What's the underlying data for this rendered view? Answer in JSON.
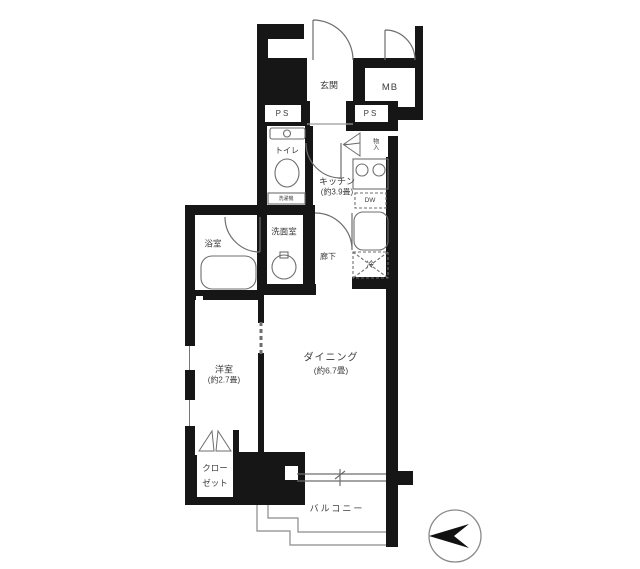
{
  "floorplan": {
    "rooms": {
      "entrance": "玄関",
      "meter_box": "MB",
      "pipe_space_left": "PS",
      "pipe_space_right": "PS",
      "toilet": "トイレ",
      "storage": "物入",
      "kitchen": "キッチン",
      "kitchen_size": "(約3.9畳)",
      "washroom": "洗面室",
      "bathroom": "浴室",
      "hallway": "廊下",
      "dining": "ダイニング",
      "dining_size": "(約6.7畳)",
      "bedroom": "洋室",
      "bedroom_size": "(約2.7畳)",
      "closet_line1": "クロー",
      "closet_line2": "ゼット",
      "balcony": "バルコニー"
    },
    "fixtures": {
      "dishwasher": "DW",
      "refrigerator": "冷",
      "washer": "洗濯機"
    },
    "colors": {
      "wall": "#161616",
      "line": "#6e6e6e",
      "text": "#3c3c3c",
      "bg": "#ffffff"
    }
  }
}
